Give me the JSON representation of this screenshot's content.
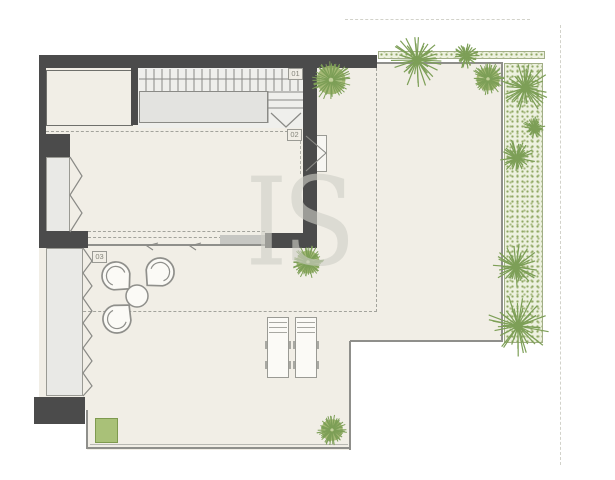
{
  "watermark": {
    "text": "IS"
  },
  "rooms": {
    "labels": [
      {
        "id": "01"
      },
      {
        "id": "02"
      },
      {
        "id": "03"
      }
    ]
  },
  "colors": {
    "wall": "#4b4b4b",
    "floor": "#f1eee6",
    "plan_line": "#8f8f8b",
    "plant_green": "#7d9f57",
    "planter_fill": "#a9c178",
    "bed_background": "#edf1df"
  },
  "plan": {
    "trees": [
      {
        "x": 331,
        "y": 80,
        "r": 20,
        "type": "bush"
      },
      {
        "x": 417,
        "y": 60,
        "r": 26,
        "type": "palm"
      },
      {
        "x": 466,
        "y": 56,
        "r": 13,
        "type": "palm"
      },
      {
        "x": 488,
        "y": 79,
        "r": 16,
        "type": "bush"
      },
      {
        "x": 525,
        "y": 88,
        "r": 24,
        "type": "palm"
      },
      {
        "x": 534,
        "y": 128,
        "r": 11,
        "type": "palm"
      },
      {
        "x": 517,
        "y": 158,
        "r": 18,
        "type": "palm"
      },
      {
        "x": 516,
        "y": 267,
        "r": 23,
        "type": "palm"
      },
      {
        "x": 518,
        "y": 326,
        "r": 30,
        "type": "palm"
      },
      {
        "x": 308,
        "y": 262,
        "r": 16,
        "type": "bush"
      },
      {
        "x": 332,
        "y": 430,
        "r": 15,
        "type": "bush"
      }
    ],
    "chairs": [
      {
        "cx": 116,
        "cy": 276,
        "r": 14,
        "angle": 44
      },
      {
        "cx": 160,
        "cy": 272,
        "r": 14,
        "angle": 134
      },
      {
        "cx": 117,
        "cy": 319,
        "r": 14,
        "angle": -49
      }
    ],
    "table": {
      "cx": 137,
      "cy": 296,
      "r": 11
    },
    "loungers": [
      {
        "x": 267,
        "y": 317,
        "w": 22,
        "h": 61
      },
      {
        "x": 295,
        "y": 317,
        "w": 22,
        "h": 61
      }
    ],
    "planter": {
      "x": 95,
      "y": 418,
      "w": 23,
      "h": 25
    }
  }
}
